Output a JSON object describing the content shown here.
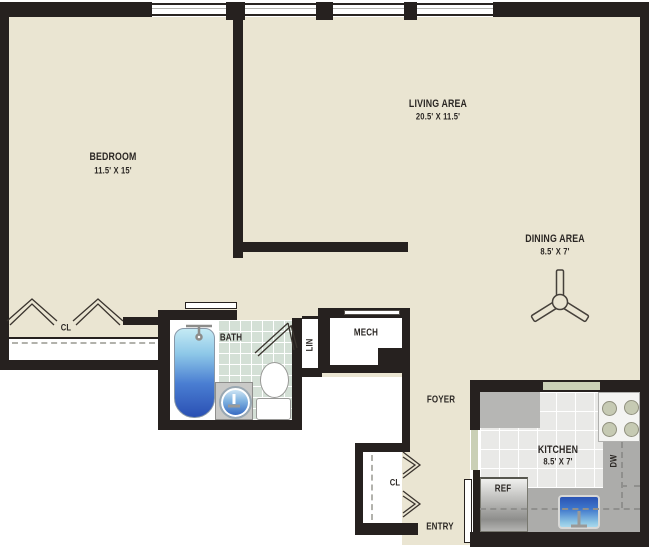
{
  "plan_title": "One-bedroom apartment floor plan",
  "rooms": {
    "bedroom": {
      "label": "BEDROOM",
      "dimensions": "11.5' X 15'"
    },
    "living_area": {
      "label": "LIVING AREA",
      "dimensions": "20.5' X 11.5'"
    },
    "dining_area": {
      "label": "DINING AREA",
      "dimensions": "8.5' X 7'"
    },
    "kitchen": {
      "label": "KITCHEN",
      "dimensions": "8.5' X 7'"
    },
    "bathroom": {
      "label": "BATH"
    },
    "mechanical": {
      "label": "MECH"
    },
    "linen_closet": {
      "label": "LIN"
    },
    "foyer": {
      "label": "FOYER"
    },
    "entry": {
      "label": "ENTRY"
    },
    "bedroom_closet": {
      "label": "CL"
    },
    "foyer_closet": {
      "label": "CL"
    }
  },
  "appliances": {
    "refrigerator": {
      "label": "REF"
    },
    "dishwasher": {
      "label": "DW"
    }
  },
  "icons": [
    "ceiling-fan-icon",
    "bathtub-icon",
    "bath-sink-icon",
    "toilet-icon",
    "kitchen-sink-icon",
    "stove-icon",
    "refrigerator-icon",
    "bifold-closet-door-icon",
    "door-swing-icon",
    "sliding-door-icon",
    "window-icon"
  ],
  "colors": {
    "wall": "#26211F",
    "floor": "#EAE5D2",
    "outside": "#FFFFFF",
    "bath_tile": "#D4E0D6",
    "kitchen_tile": "#E9E9E7",
    "counter": "#ACACAA",
    "sage_opening": "#CAD0B6",
    "tub_top": "#C4EAF4",
    "tub_bottom": "#2A50B4",
    "sink_blue": "#2F62BE",
    "text": "#2B2724"
  }
}
